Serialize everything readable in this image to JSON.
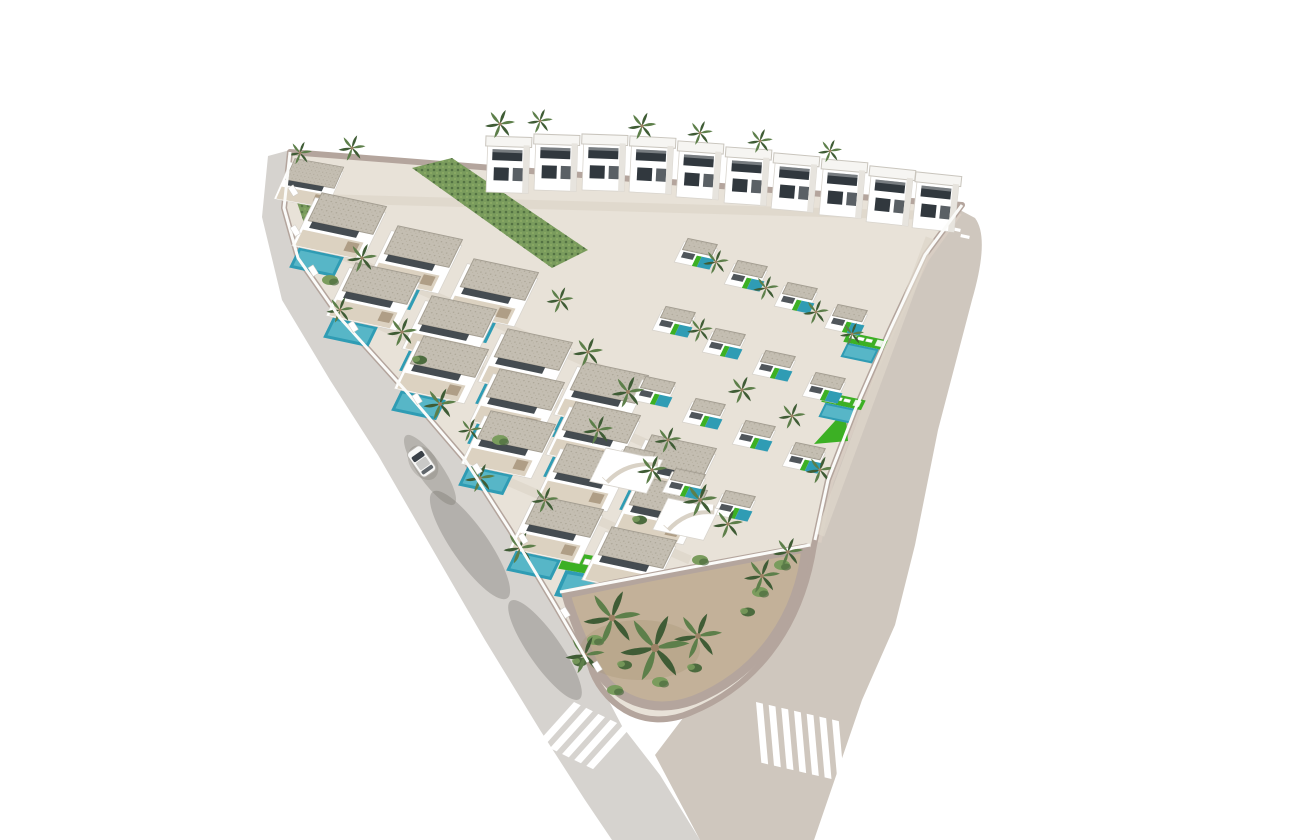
{
  "scene": {
    "description": "Aerial 3D architectural rendering of a triangular residential development of white Mediterranean-style villas with flat gravel roofs, private turquoise swimming pools, bright green lawns with sun loungers and many palm trees. Two roads border the plot and meet at a rounded landscaped corner planted with tall palms; a zebra crosswalk crosses each road beside the corner. A single white car drives on the left gray road. A back row of taller two-story villas with dark recessed terraces lines the top edge. Pure white background.",
    "style": "photorealistic CGI aerial view",
    "background": "white"
  },
  "palette": {
    "road_gray": "#d6d3cf",
    "road_beige": "#cfc7be",
    "curb": "#b4a59d",
    "pavement": "#e8e2d8",
    "terrace": "#dcd2c1",
    "wall": "#ffffff",
    "roof": "#c4beb2",
    "opening": "#31383e",
    "pool": "#2f9cb4",
    "lawn": "#3cb024",
    "veg": "#7a9c5d",
    "frond": "#5d7f4a",
    "dirt": "#c3b199"
  },
  "inventory": {
    "two_story_villas": 10,
    "single_story_villas": 17,
    "terraced_units": 15,
    "swimming_pools": 34,
    "palm_trees": 38,
    "crosswalks": 2,
    "cars": 1,
    "roads": 2
  }
}
